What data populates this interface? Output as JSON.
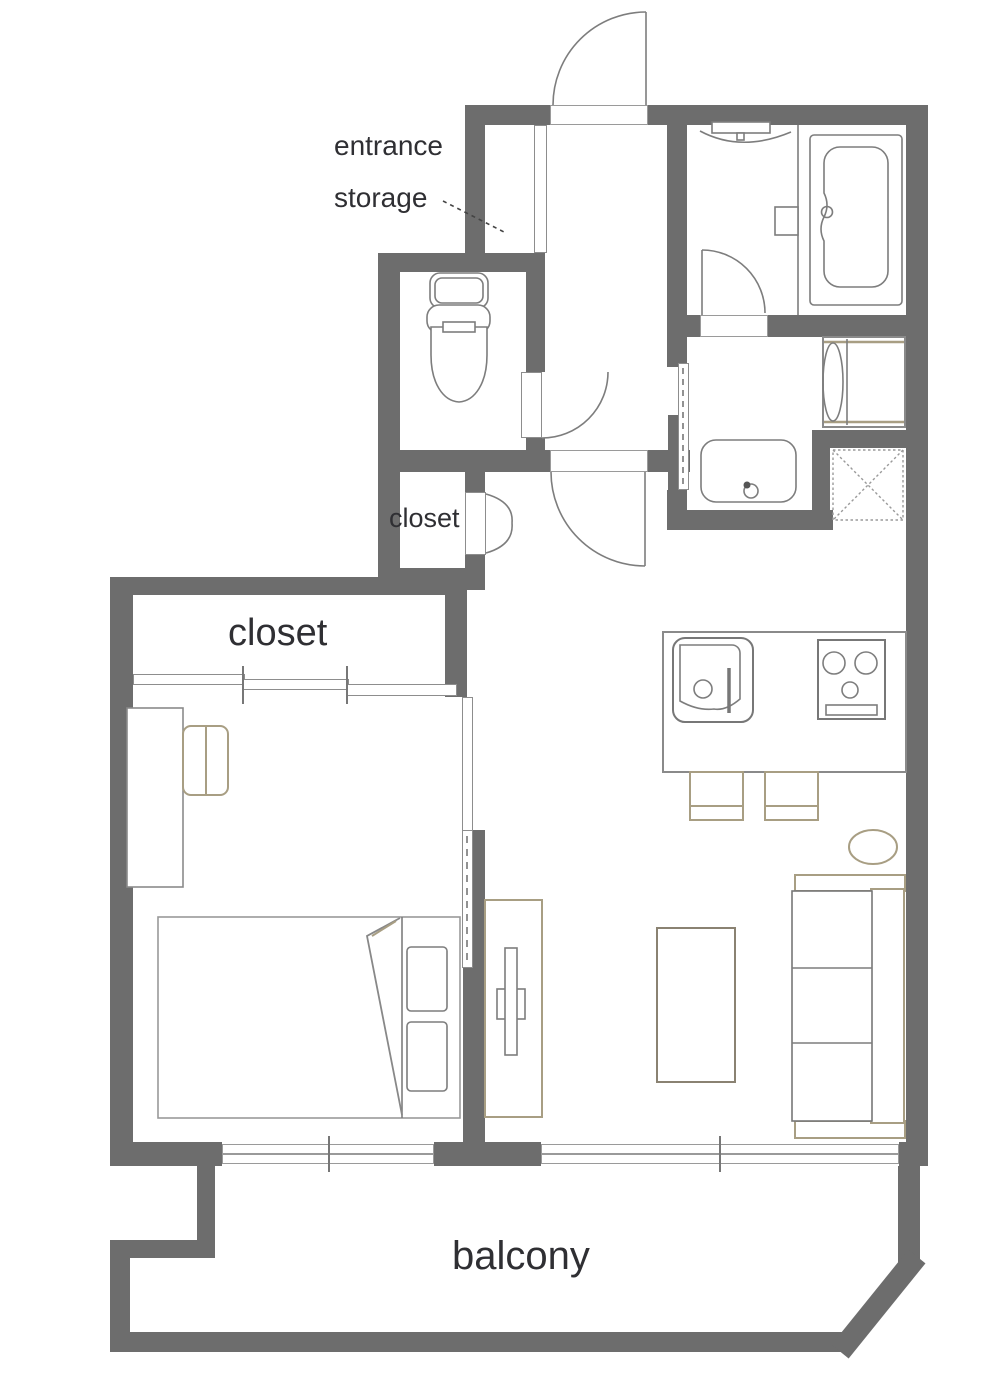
{
  "floor_plan": {
    "labels": {
      "entrance_storage_line1": "entrance",
      "entrance_storage_line2": "storage",
      "closet_small": "closet",
      "closet_large": "closet",
      "balcony": "balcony"
    },
    "fixtures": [
      "entrance-door",
      "entrance-storage-cabinet",
      "shower",
      "bathtub",
      "toilet",
      "washing-machine",
      "washbasin",
      "refrigerator-space",
      "kitchen-counter",
      "kitchen-sink",
      "stove",
      "dining-chairs",
      "stool-cushion",
      "sofa",
      "coffee-table",
      "tv-board",
      "bed",
      "desk",
      "desk-chair",
      "closet-sliding-doors",
      "bifold-closet-door",
      "windows"
    ],
    "colors": {
      "wall": "#6d6d6d",
      "fixture_line": "#7d7d7d",
      "furniture_accent": "#a89e83",
      "text": "#2f2f33",
      "background": "#ffffff"
    }
  }
}
